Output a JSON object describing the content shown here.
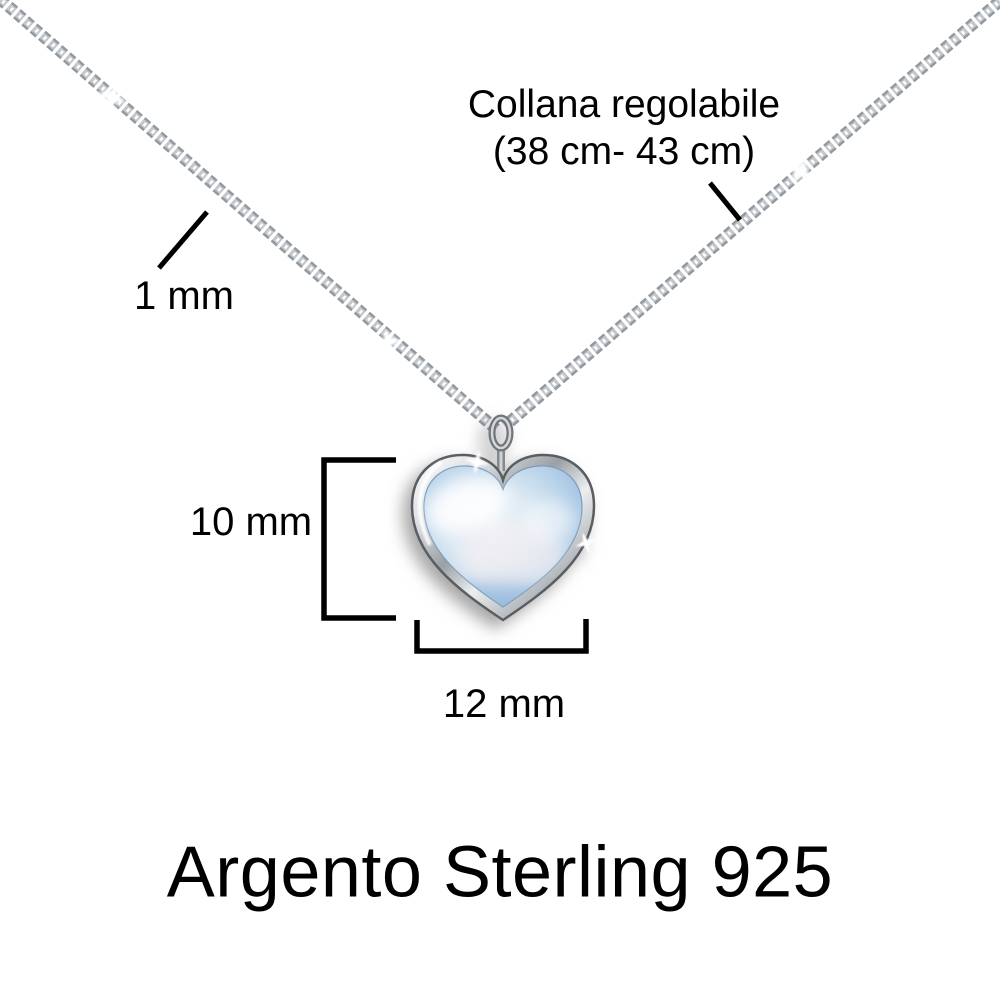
{
  "page": {
    "background": "#ffffff",
    "kind": "product dimension diagram of a necklace with heart pendant"
  },
  "labels": {
    "chain_adjustable_line1": "Collana regolabile",
    "chain_adjustable_line2": "(38 cm- 43 cm)",
    "chain_thickness": "1 mm",
    "pendant_height": "10 mm",
    "pendant_width": "12 mm",
    "material": "Argento Sterling 925"
  },
  "colors": {
    "text": "#000000",
    "annotation_lines": "#000000",
    "chain_silver_dark": "#9299a0",
    "chain_silver_light": "#c3c8cd",
    "chain_highlight": "#ffffff",
    "bezel_silver": "#c9cdd1",
    "bezel_edge": "#5a5e62",
    "stone_blue_edge": "#8db4da",
    "stone_blue_mid": "#bcd5eb",
    "stone_blue_light": "#eef4f9",
    "stone_pearl_pink": "#f6eff1"
  }
}
